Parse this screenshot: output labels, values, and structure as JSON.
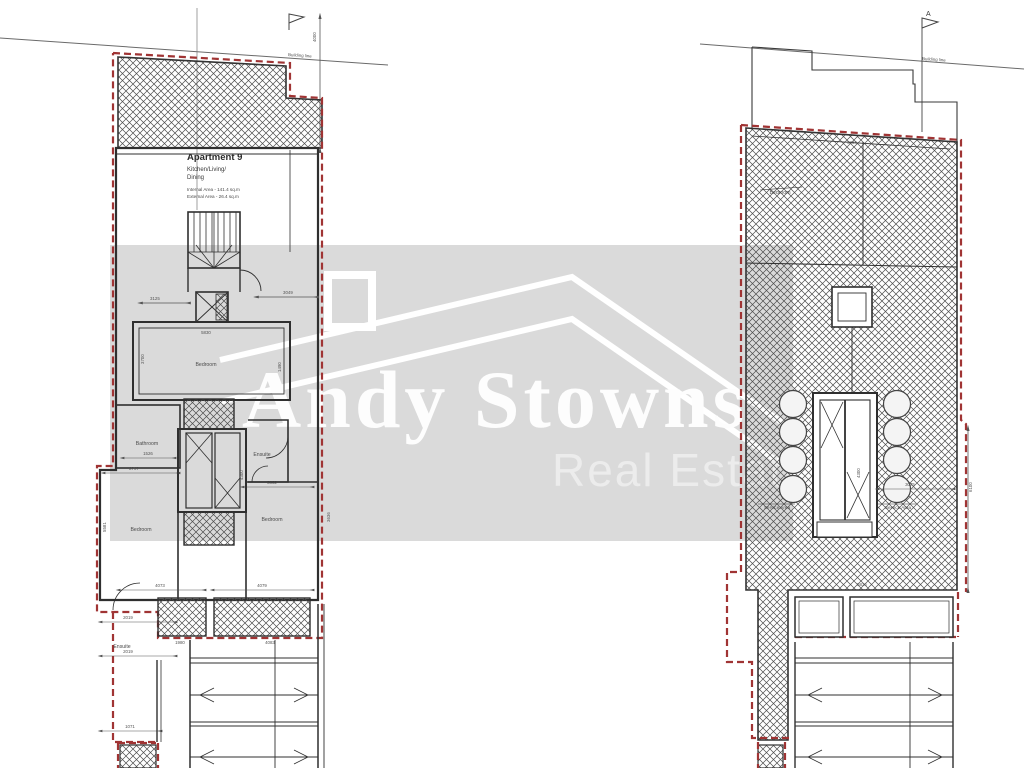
{
  "watermark": {
    "brand_line1": "Andy Stowns",
    "brand_line2": "Real Estate",
    "bg_color": "#dadada",
    "text_color": "#fdfdfd"
  },
  "colors": {
    "boundary_red": "#a03434",
    "wall": "#333333"
  },
  "left_plan": {
    "title_block": {
      "title": "Apartment 9",
      "room_line1": "Kitchen/Living/",
      "room_line2": "Dining",
      "internal_area": "Internal Area - 141.4 sq.m",
      "external_area": "External Area - 26.4 sq.m"
    },
    "labels": {
      "bedroom_mid": "Bedroom",
      "bathroom": "Bathroom",
      "ensuite_upper": "Ensuite",
      "bedroom_left": "Bedroom",
      "bedroom_right": "Bedroom",
      "ensuite_lower": "Ensuite"
    },
    "building_line": "Building line",
    "dims": {
      "v4000": "4000",
      "h3125": "3125",
      "h3049": "3049",
      "h5830": "5830",
      "v3700": "3700",
      "v1490": "1490",
      "h1526": "1526",
      "h2707": "2707",
      "v4300": "4300",
      "h3662": "3662",
      "v3636": "3636",
      "v5581": "5581",
      "h4073": "4073",
      "h4079": "4079",
      "h2019a": "2019",
      "h2019b": "2019",
      "h1980": "1980",
      "h4083": "4083",
      "h1071": "1071"
    }
  },
  "right_plan": {
    "section_marker": "A",
    "building_line": "Building line",
    "labels": {
      "bedroom": "Bedroom",
      "service_left": "Service Area",
      "service_right": "Service Area"
    },
    "dims": {
      "h5834": "5834",
      "h5836": "5836",
      "h3075": "3075",
      "v4300": "4300",
      "v6100": "6100"
    }
  }
}
